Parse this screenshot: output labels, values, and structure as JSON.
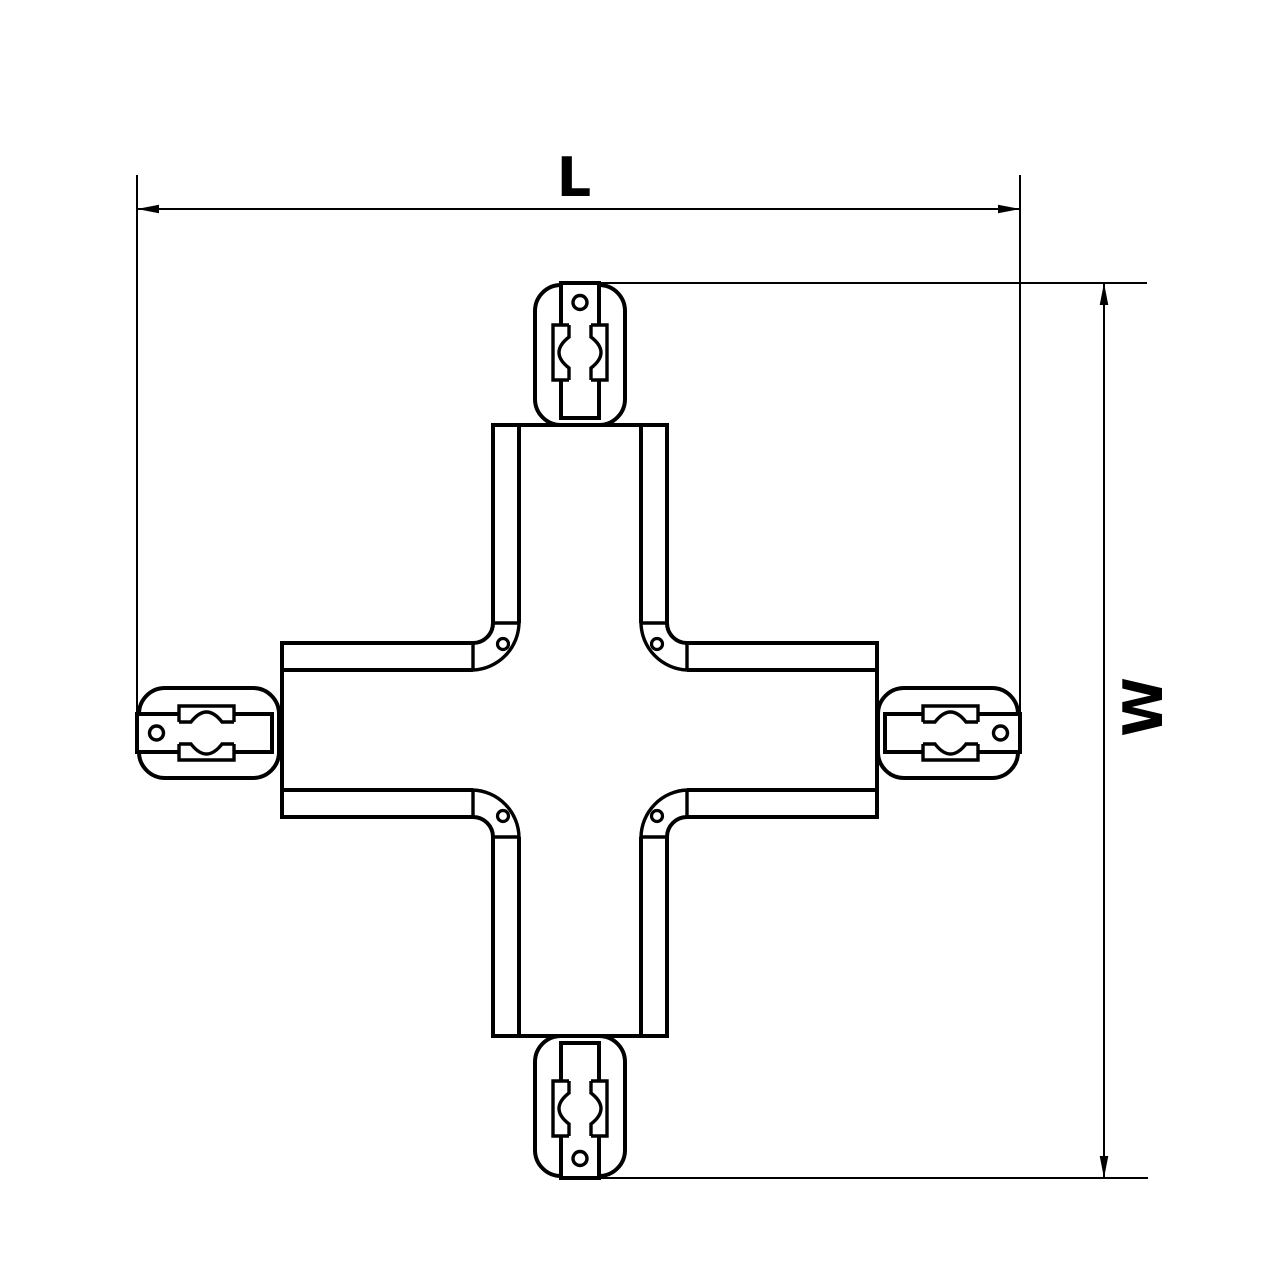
{
  "drawing": {
    "labels": {
      "length": "L",
      "width": "W"
    },
    "colors": {
      "line": "#000000",
      "background": "#ffffff"
    }
  }
}
